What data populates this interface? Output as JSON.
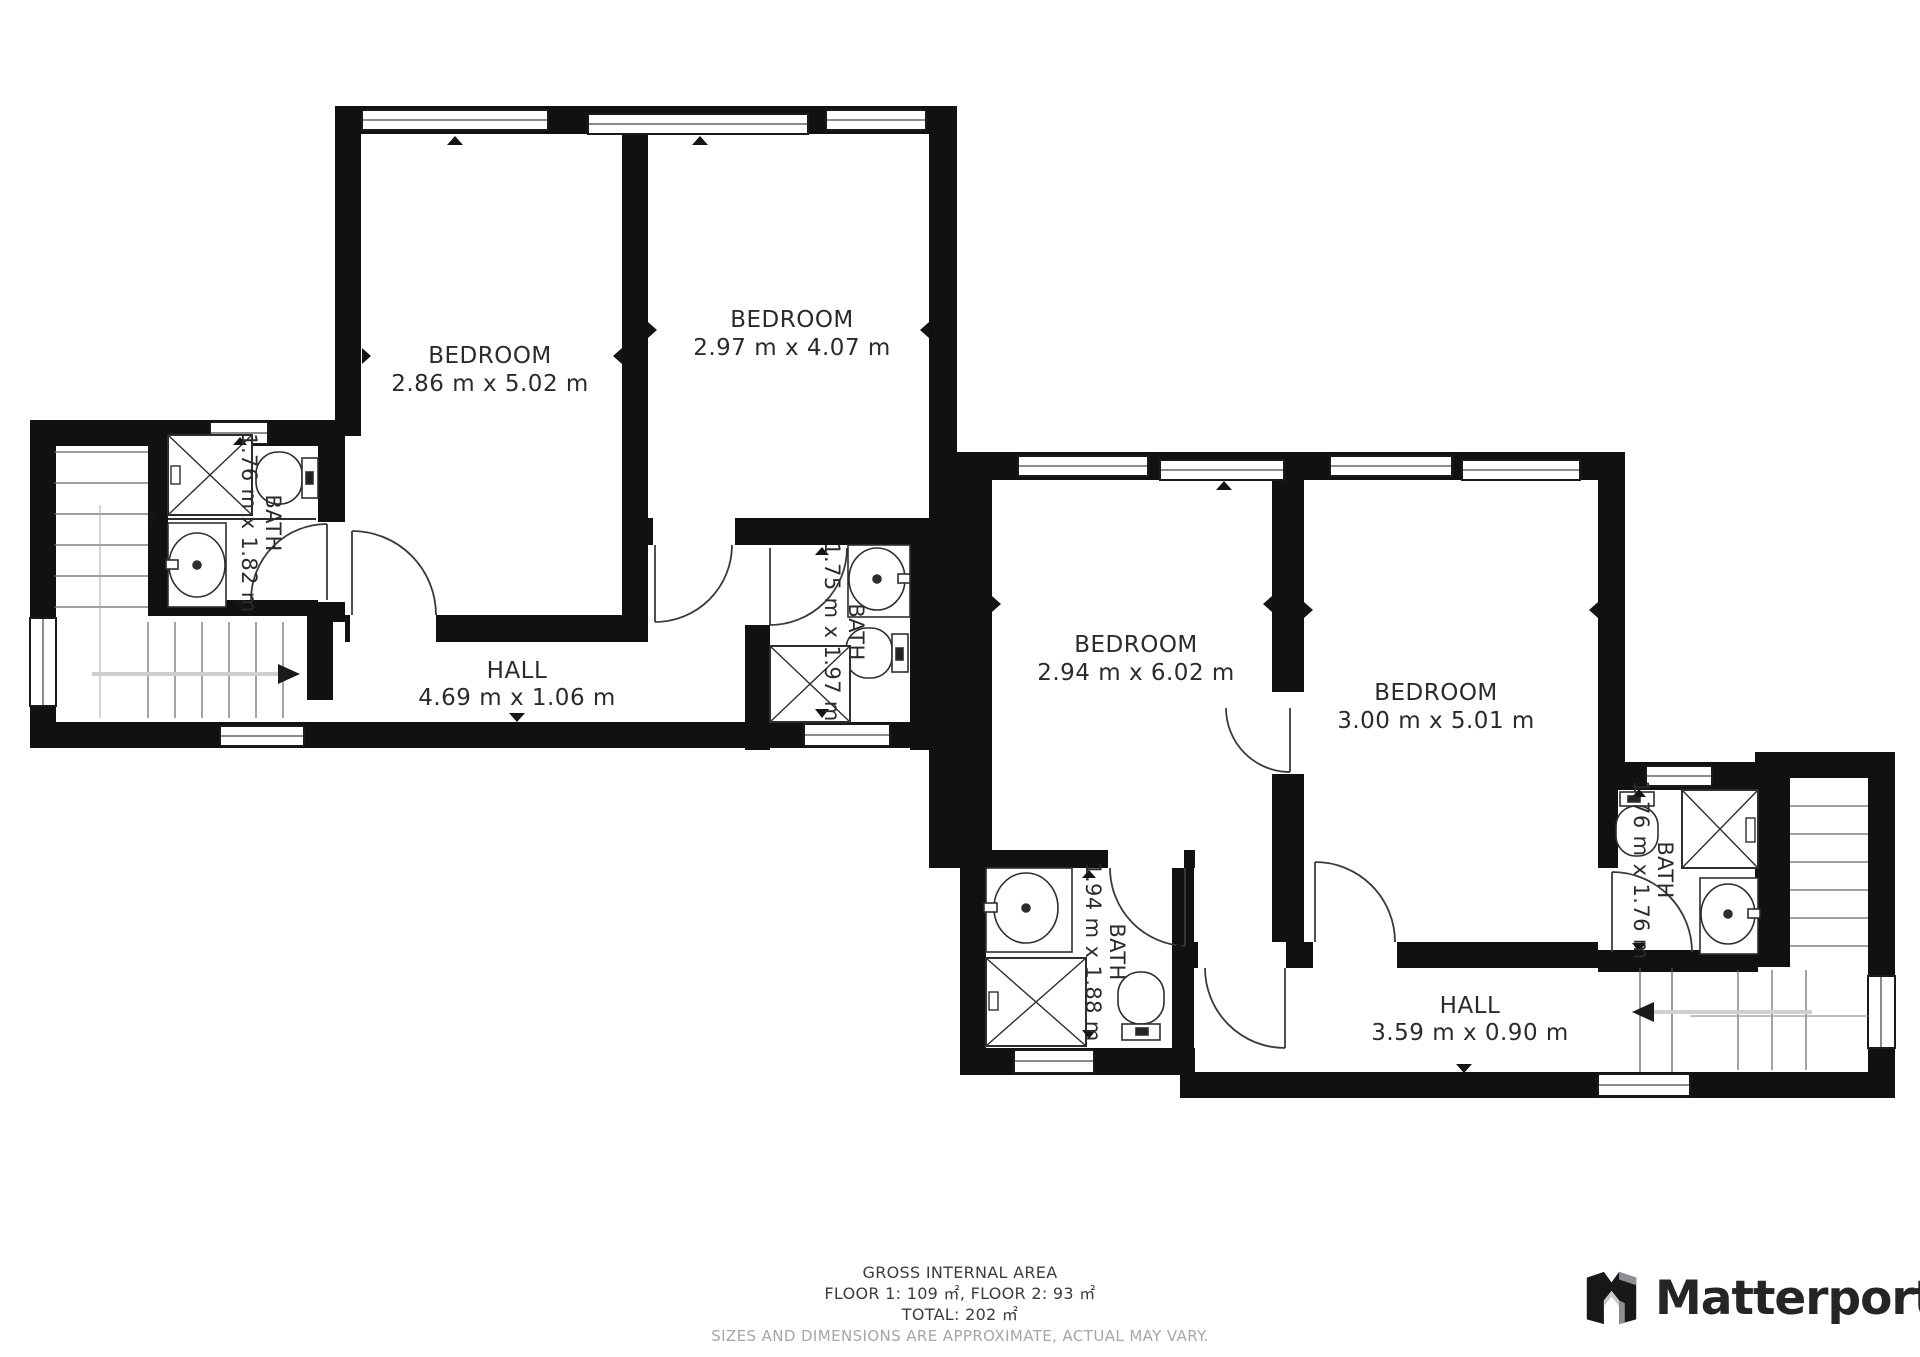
{
  "plan": {
    "rooms": {
      "bedroom1": {
        "name": "BEDROOM",
        "dims": "2.86 m x 5.02 m"
      },
      "bedroom2": {
        "name": "BEDROOM",
        "dims": "2.97 m x 4.07 m"
      },
      "bedroom3": {
        "name": "BEDROOM",
        "dims": "2.94 m x 6.02 m"
      },
      "bedroom4": {
        "name": "BEDROOM",
        "dims": "3.00 m x 5.01 m"
      },
      "bath1": {
        "name": "BATH",
        "dims": "1.76 m x 1.82 m"
      },
      "bath2": {
        "name": "BATH",
        "dims": "1.75 m x 1.97 m"
      },
      "bath3": {
        "name": "BATH",
        "dims": "1.94 m x 1.88 m"
      },
      "bath4": {
        "name": "BATH",
        "dims": "1.76 m x 1.76 m"
      },
      "hall1": {
        "name": "HALL",
        "dims": "4.69 m x 1.06 m"
      },
      "hall2": {
        "name": "HALL",
        "dims": "3.59 m x 0.90 m"
      }
    }
  },
  "footer": {
    "title": "GROSS INTERNAL AREA",
    "floors": "FLOOR 1: 109 ㎡, FLOOR 2: 93 ㎡",
    "total": "TOTAL: 202 ㎡",
    "disclaimer": "SIZES AND DIMENSIONS ARE APPROXIMATE, ACTUAL MAY VARY."
  },
  "branding": {
    "logo_text": "Matterport"
  },
  "colors": {
    "wall": "#111111",
    "marker": "#151515",
    "logo_gray": "#8e8e93",
    "disclaimer_gray": "#a6a6a6",
    "stair_arrow": "#cfcfcf"
  }
}
